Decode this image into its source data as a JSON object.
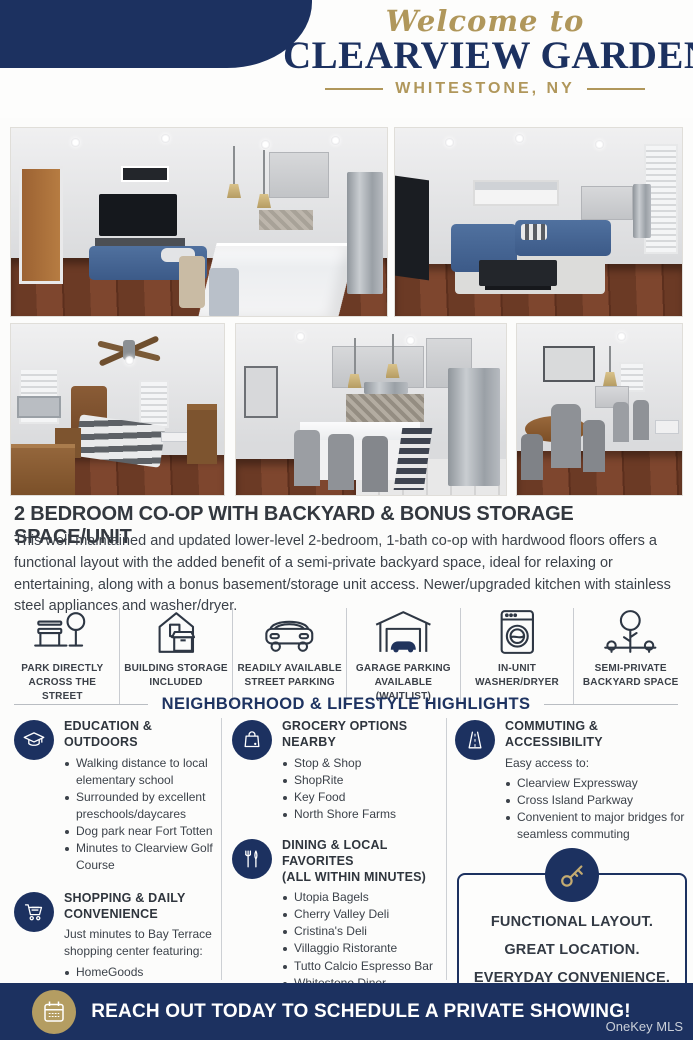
{
  "colors": {
    "navy": "#1c3160",
    "gold": "#b0975b",
    "tan_circle": "#b49d62",
    "text_dark": "#33383f"
  },
  "header": {
    "welcome": "Welcome to",
    "title": "CLEARVIEW GARDENS",
    "location": "WHITESTONE, NY"
  },
  "listing": {
    "headline": "2 BEDROOM CO-OP WITH BACKYARD & BONUS STORAGE SPACE/UNIT",
    "description": "This well-maintained and updated lower-level 2-bedroom, 1-bath co-op with hardwood floors offers a functional layout with the added benefit of a semi-private backyard space, ideal for relaxing or entertaining, along with a bonus basement/storage unit access. Newer/upgraded kitchen with stainless steel appliances and washer/dryer."
  },
  "features": [
    {
      "icon": "park-bench-tree-icon",
      "label": "PARK DIRECTLY ACROSS THE STREET"
    },
    {
      "icon": "building-storage-icon",
      "label": "BUILDING STORAGE INCLUDED"
    },
    {
      "icon": "car-icon",
      "label": "READILY AVAILABLE STREET PARKING"
    },
    {
      "icon": "garage-icon",
      "label": "GARAGE PARKING AVAILABLE (WAITLIST)"
    },
    {
      "icon": "washer-icon",
      "label": "IN-UNIT WASHER/DRYER"
    },
    {
      "icon": "backyard-tree-icon",
      "label": "SEMI-PRIVATE BACKYARD SPACE"
    }
  ],
  "highlights": {
    "section_title": "NEIGHBORHOOD & LIFESTYLE HIGHLIGHTS",
    "education": {
      "title": "EDUCATION & OUTDOORS",
      "items": [
        "Walking distance to local elementary school",
        "Surrounded by excellent preschools/daycares",
        "Dog park near Fort Totten",
        "Minutes to Clearview Golf Course"
      ]
    },
    "shopping": {
      "title": "SHOPPING & DAILY CONVENIENCE",
      "intro": "Just minutes to Bay Terrace shopping center featuring:",
      "items": [
        "HomeGoods",
        "Old Navy",
        "IHOP"
      ]
    },
    "grocery": {
      "title": "GROCERY OPTIONS NEARBY",
      "items": [
        "Stop & Shop",
        "ShopRite",
        "Key Food",
        "North Shore Farms"
      ]
    },
    "dining": {
      "title": "DINING & LOCAL FAVORITES",
      "subtitle": "(ALL WITHIN MINUTES)",
      "items": [
        "Utopia Bagels",
        "Cherry Valley Deli",
        "Cristina's Deli",
        "Villaggio Ristorante",
        "Tutto Calcio Espresso Bar",
        "Whitestone Diner"
      ],
      "note": "Plus the charming shops along 14th Avenue, including butcher, specialty markets, and Italian bakeries."
    },
    "commuting": {
      "title": "COMMUTING & ACCESSIBILITY",
      "intro": "Easy access to:",
      "items": [
        "Clearview Expressway",
        "Cross Island Parkway",
        "Convenient to major bridges for seamless commuting"
      ]
    }
  },
  "callout": {
    "line1": "FUNCTIONAL LAYOUT.",
    "line2": "GREAT LOCATION.",
    "line3": "EVERYDAY CONVENIENCE.",
    "script": "Don't Miss This Opportunity!"
  },
  "footer": {
    "cta": "REACH OUT TODAY TO SCHEDULE A PRIVATE SHOWING!",
    "watermark": "OneKey MLS"
  }
}
